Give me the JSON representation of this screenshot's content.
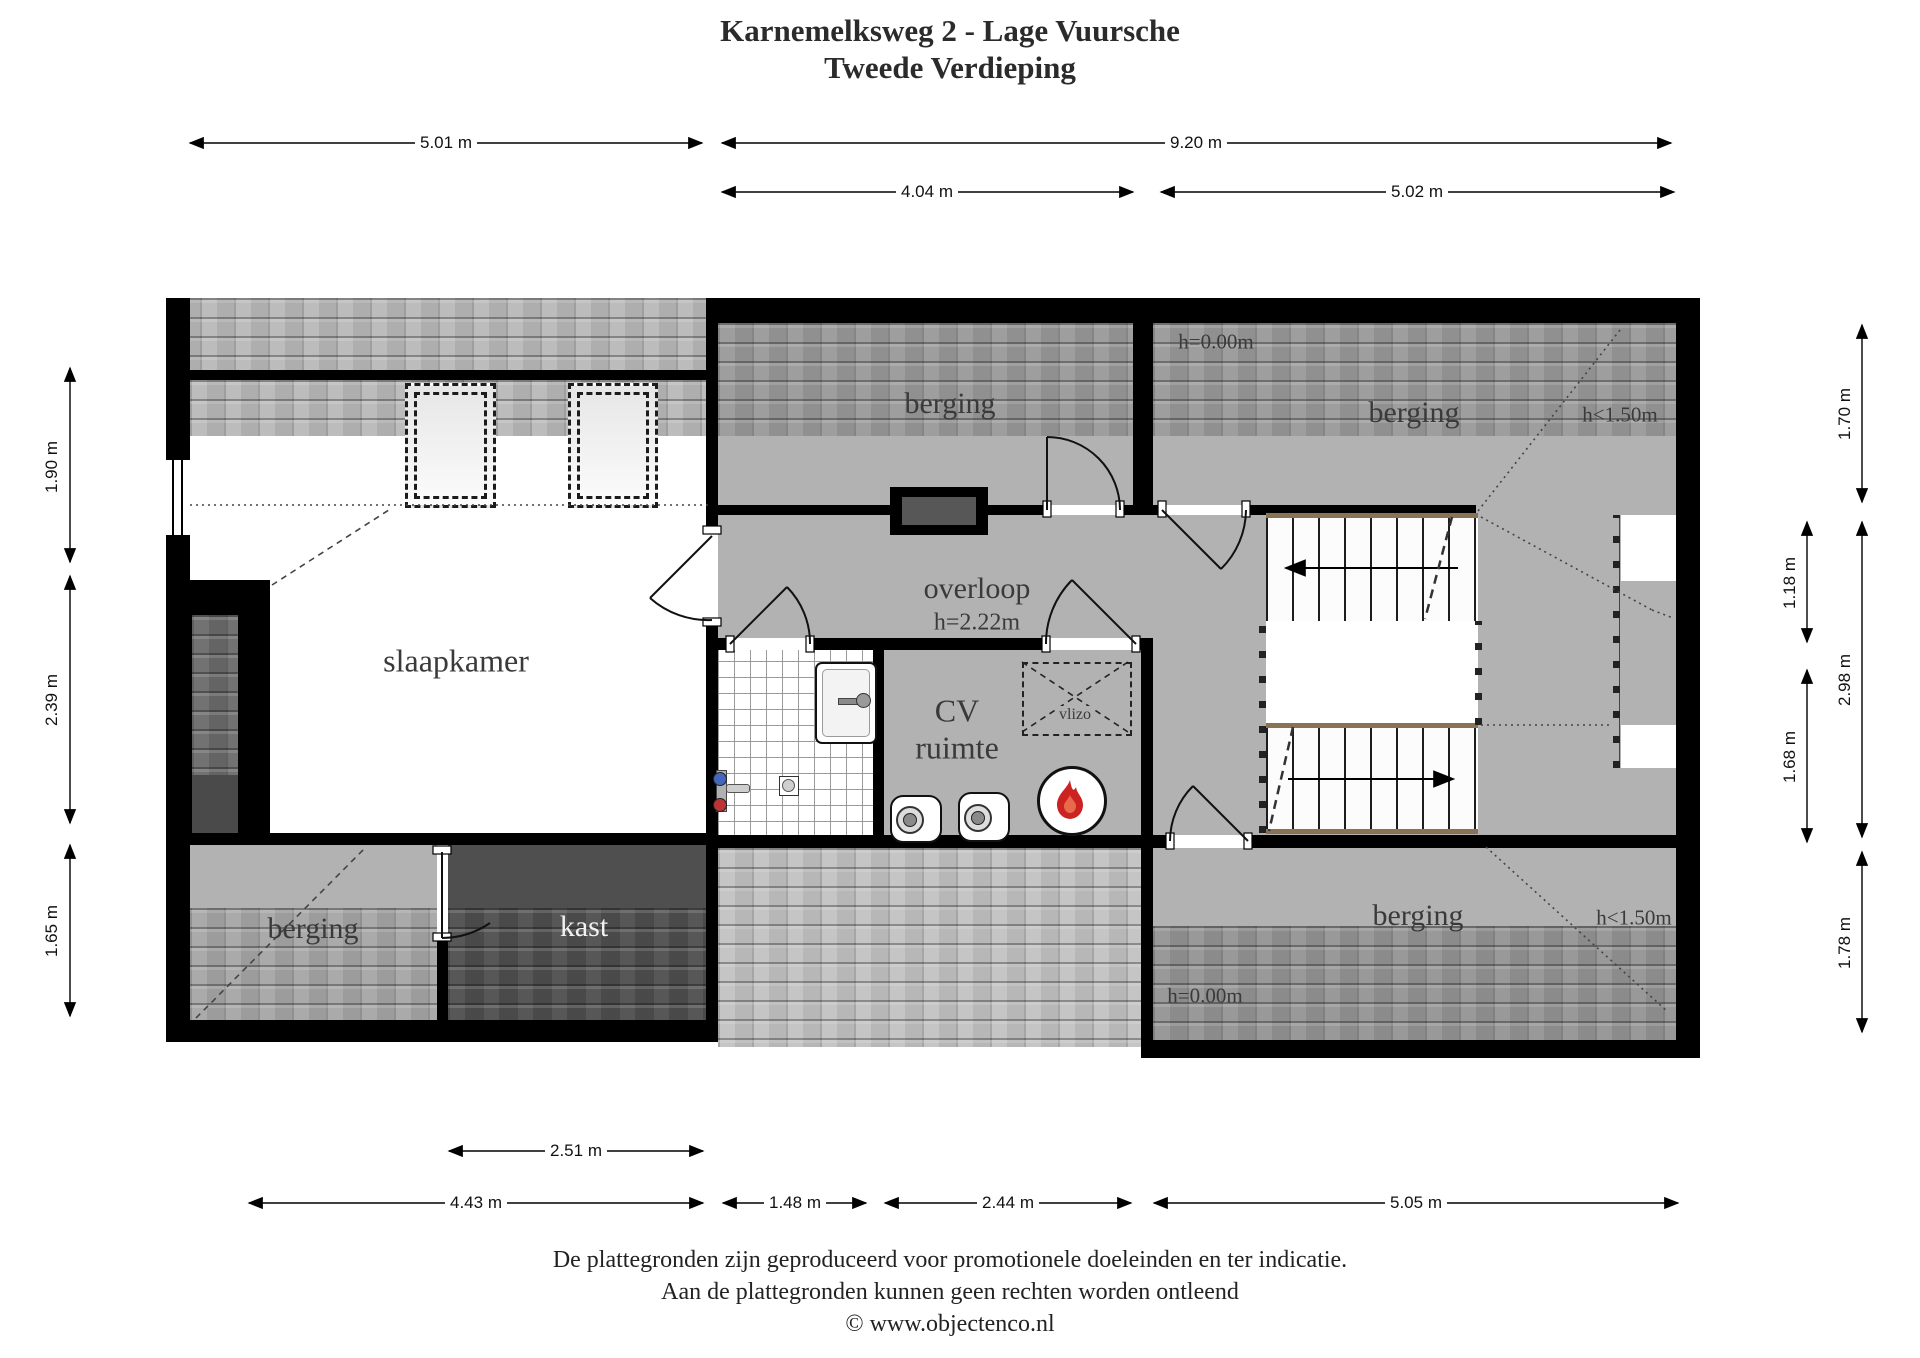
{
  "title": {
    "line1": "Karnemelksweg 2 - Lage Vuursche",
    "line2": "Tweede Verdieping"
  },
  "rooms": {
    "slaapkamer": "slaapkamer",
    "overloop": "overloop",
    "overloop_height": "h=2.22m",
    "cv_line1": "CV",
    "cv_line2": "ruimte",
    "vlizo": "vlizo",
    "kast": "kast",
    "berging_top_middle": "berging",
    "berging_top_right": "berging",
    "berging_bottom_left": "berging",
    "berging_bottom_right": "berging"
  },
  "annotations": {
    "h000_top": "h=0.00m",
    "h000_bottom": "h=0.00m",
    "h150_top": "h<1.50m",
    "h150_bottom": "h<1.50m"
  },
  "dims": {
    "top1_left": "5.01 m",
    "top1_right": "9.20 m",
    "top2_left": "4.04 m",
    "top2_right": "5.02 m",
    "bottom1": "2.51 m",
    "bottom2_a": "4.43 m",
    "bottom2_b": "1.48 m",
    "bottom2_c": "2.44 m",
    "bottom2_d": "5.05 m",
    "left_1": "1.90 m",
    "left_2": "2.39 m",
    "left_3": "1.65 m",
    "right_inner_1": "1.18 m",
    "right_inner_2": "1.68 m",
    "right_outer_1": "1.70 m",
    "right_outer_2": "2.98 m",
    "right_outer_3": "1.78 m"
  },
  "footer": {
    "line1": "De plattegronden zijn geproduceerd voor promotionele doeleinden en ter indicatie.",
    "line2": "Aan de plattegronden kunnen geen rechten worden ontleend",
    "line3": "© www.objectenco.nl"
  },
  "colors": {
    "wall": "#000000",
    "interior": "#b2b2b2",
    "tiles_light": "#b9b9b9",
    "tiles_dark": "#4e4e4e",
    "stair_wood": "#8a7355",
    "flame": "#cc2222"
  }
}
